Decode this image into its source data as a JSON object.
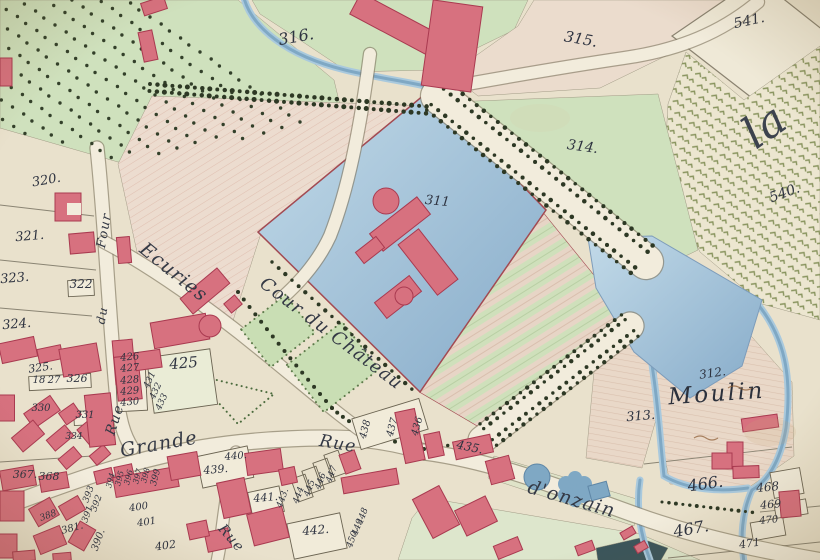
{
  "map": {
    "description": "Hand-drawn cadastral map of a village with moated chateau, courtyard, mill and vineyards",
    "palette": {
      "parchment": "#e9e1cc",
      "parchment_light": "#f2ecdc",
      "field_green": "#cfe1bd",
      "field_pink": "#ecdccf",
      "water": "#9dbdd6",
      "water_deep": "#7fa8c4",
      "water_edge": "#7d9cba",
      "building_red": "#d7717f",
      "building_stroke": "#a93a50",
      "boundary_red": "#a34a52",
      "ink": "#2e3340",
      "tree": "#2d3824",
      "vine": "#7e8b52",
      "road": "#f2ecdc",
      "road_edge": "#847b66",
      "hedge_green": "#5d7a4a"
    },
    "street_labels": [
      {
        "text": "Ecuries",
        "x": 170,
        "y": 277,
        "rot": 39,
        "size": 19,
        "cls": "street"
      },
      {
        "text": "Cour du Château",
        "x": 328,
        "y": 338,
        "rot": 37,
        "size": 18,
        "cls": "street"
      },
      {
        "text": "Four",
        "x": 108,
        "y": 231,
        "rot": -80,
        "size": 13,
        "cls": "street"
      },
      {
        "text": "du",
        "x": 106,
        "y": 316,
        "rot": -80,
        "size": 12,
        "cls": "street"
      },
      {
        "text": "Rue",
        "x": 119,
        "y": 421,
        "rot": -72,
        "size": 14,
        "cls": "street"
      },
      {
        "text": "Grande",
        "x": 160,
        "y": 450,
        "rot": -10,
        "size": 19,
        "cls": "street"
      },
      {
        "text": "Rue",
        "x": 337,
        "y": 449,
        "rot": 10,
        "size": 17,
        "cls": "street"
      },
      {
        "text": "d'onzain",
        "x": 570,
        "y": 505,
        "rot": 16,
        "size": 19,
        "cls": "street"
      },
      {
        "text": "Rue",
        "x": 228,
        "y": 541,
        "rot": 49,
        "size": 14,
        "cls": "street"
      },
      {
        "text": "Moulin",
        "x": 717,
        "y": 401,
        "rot": -4,
        "size": 23,
        "cls": "place"
      },
      {
        "text": "la",
        "x": 773,
        "y": 138,
        "rot": -35,
        "size": 44,
        "cls": "place-big"
      }
    ],
    "parcel_labels": [
      {
        "text": "316.",
        "x": 297,
        "y": 42,
        "rot": -10,
        "size": 16
      },
      {
        "text": "315.",
        "x": 580,
        "y": 44,
        "rot": 10,
        "size": 15
      },
      {
        "text": "541.",
        "x": 750,
        "y": 25,
        "rot": -12,
        "size": 14
      },
      {
        "text": "314.",
        "x": 582,
        "y": 151,
        "rot": 8,
        "size": 14
      },
      {
        "text": "540.",
        "x": 786,
        "y": 197,
        "rot": -20,
        "size": 14
      },
      {
        "text": "311",
        "x": 437,
        "y": 205,
        "rot": 5,
        "size": 13
      },
      {
        "text": "320.",
        "x": 47,
        "y": 184,
        "rot": -10,
        "size": 13
      },
      {
        "text": "321.",
        "x": 30,
        "y": 240,
        "rot": -5,
        "size": 13
      },
      {
        "text": "322",
        "x": 81,
        "y": 288,
        "rot": 0,
        "size": 12
      },
      {
        "text": "323.",
        "x": 15,
        "y": 282,
        "rot": -5,
        "size": 13
      },
      {
        "text": "324.",
        "x": 17,
        "y": 328,
        "rot": -5,
        "size": 13
      },
      {
        "text": "325.",
        "x": 41,
        "y": 371,
        "rot": -8,
        "size": 11
      },
      {
        "text": "18",
        "x": 39,
        "y": 383,
        "rot": 0,
        "size": 10
      },
      {
        "text": "27",
        "x": 54,
        "y": 383,
        "rot": 0,
        "size": 10
      },
      {
        "text": "326",
        "x": 77,
        "y": 382,
        "rot": 0,
        "size": 11
      },
      {
        "text": "330",
        "x": 41,
        "y": 411,
        "rot": 0,
        "size": 10
      },
      {
        "text": "331",
        "x": 85,
        "y": 418,
        "rot": 0,
        "size": 10
      },
      {
        "text": "334",
        "x": 74,
        "y": 439,
        "rot": 0,
        "size": 9
      },
      {
        "text": "367.",
        "x": 25,
        "y": 478,
        "rot": 0,
        "size": 11
      },
      {
        "text": "368",
        "x": 49,
        "y": 480,
        "rot": 0,
        "size": 11
      },
      {
        "text": "388",
        "x": 49,
        "y": 518,
        "rot": -20,
        "size": 9
      },
      {
        "text": "381.",
        "x": 73,
        "y": 531,
        "rot": -15,
        "size": 10
      },
      {
        "text": "393",
        "x": 91,
        "y": 495,
        "rot": -70,
        "size": 9
      },
      {
        "text": "392",
        "x": 99,
        "y": 504,
        "rot": -70,
        "size": 9
      },
      {
        "text": "391",
        "x": 90,
        "y": 515,
        "rot": -70,
        "size": 9
      },
      {
        "text": "390.",
        "x": 101,
        "y": 541,
        "rot": -70,
        "size": 10
      },
      {
        "text": "394",
        "x": 113,
        "y": 481,
        "rot": -75,
        "size": 8
      },
      {
        "text": "395",
        "x": 122,
        "y": 479,
        "rot": -75,
        "size": 8
      },
      {
        "text": "396",
        "x": 131,
        "y": 478,
        "rot": -75,
        "size": 8
      },
      {
        "text": "397",
        "x": 140,
        "y": 477,
        "rot": -75,
        "size": 8
      },
      {
        "text": "398",
        "x": 148,
        "y": 476,
        "rot": -75,
        "size": 8
      },
      {
        "text": "399",
        "x": 158,
        "y": 478,
        "rot": -75,
        "size": 9
      },
      {
        "text": "400",
        "x": 139,
        "y": 510,
        "rot": -8,
        "size": 10
      },
      {
        "text": "401",
        "x": 147,
        "y": 525,
        "rot": -8,
        "size": 10
      },
      {
        "text": "402",
        "x": 166,
        "y": 549,
        "rot": -8,
        "size": 11
      },
      {
        "text": "425",
        "x": 184,
        "y": 368,
        "rot": -5,
        "size": 15
      },
      {
        "text": "426",
        "x": 130,
        "y": 360,
        "rot": -5,
        "size": 10
      },
      {
        "text": "427",
        "x": 130,
        "y": 371,
        "rot": -5,
        "size": 10
      },
      {
        "text": "428",
        "x": 130,
        "y": 383,
        "rot": -5,
        "size": 10
      },
      {
        "text": "429",
        "x": 130,
        "y": 394,
        "rot": -5,
        "size": 10
      },
      {
        "text": "430",
        "x": 130,
        "y": 405,
        "rot": -5,
        "size": 10
      },
      {
        "text": "431",
        "x": 152,
        "y": 381,
        "rot": -65,
        "size": 9
      },
      {
        "text": "432",
        "x": 158,
        "y": 392,
        "rot": -65,
        "size": 9
      },
      {
        "text": "433",
        "x": 164,
        "y": 403,
        "rot": -65,
        "size": 9
      },
      {
        "text": "439.",
        "x": 216,
        "y": 473,
        "rot": -5,
        "size": 11
      },
      {
        "text": "440.",
        "x": 236,
        "y": 459,
        "rot": -5,
        "size": 10
      },
      {
        "text": "441.",
        "x": 266,
        "y": 501,
        "rot": -5,
        "size": 11
      },
      {
        "text": "442.",
        "x": 316,
        "y": 534,
        "rot": -5,
        "size": 12
      },
      {
        "text": "443.",
        "x": 285,
        "y": 499,
        "rot": -70,
        "size": 9
      },
      {
        "text": "444",
        "x": 301,
        "y": 496,
        "rot": -70,
        "size": 9
      },
      {
        "text": "445",
        "x": 312,
        "y": 489,
        "rot": -70,
        "size": 9
      },
      {
        "text": "446",
        "x": 323,
        "y": 482,
        "rot": -70,
        "size": 9
      },
      {
        "text": "447",
        "x": 334,
        "y": 475,
        "rot": -70,
        "size": 9
      },
      {
        "text": "448",
        "x": 365,
        "y": 517,
        "rot": -70,
        "size": 9
      },
      {
        "text": "449",
        "x": 360,
        "y": 528,
        "rot": -70,
        "size": 9
      },
      {
        "text": "450.",
        "x": 355,
        "y": 539,
        "rot": -70,
        "size": 9
      },
      {
        "text": "435.",
        "x": 469,
        "y": 451,
        "rot": 12,
        "size": 12
      },
      {
        "text": "436",
        "x": 420,
        "y": 427,
        "rot": -75,
        "size": 10
      },
      {
        "text": "437",
        "x": 395,
        "y": 428,
        "rot": -75,
        "size": 10
      },
      {
        "text": "438",
        "x": 368,
        "y": 430,
        "rot": -75,
        "size": 10
      },
      {
        "text": "312.",
        "x": 713,
        "y": 377,
        "rot": -8,
        "size": 12
      },
      {
        "text": "313.",
        "x": 641,
        "y": 420,
        "rot": -5,
        "size": 13
      },
      {
        "text": "466.",
        "x": 706,
        "y": 489,
        "rot": -8,
        "size": 16
      },
      {
        "text": "467.",
        "x": 692,
        "y": 534,
        "rot": -10,
        "size": 16
      },
      {
        "text": "468",
        "x": 768,
        "y": 491,
        "rot": -5,
        "size": 12
      },
      {
        "text": "469",
        "x": 771,
        "y": 508,
        "rot": -5,
        "size": 11
      },
      {
        "text": "470",
        "x": 769,
        "y": 523,
        "rot": -5,
        "size": 10
      },
      {
        "text": "471",
        "x": 750,
        "y": 547,
        "rot": -8,
        "size": 11
      }
    ]
  }
}
